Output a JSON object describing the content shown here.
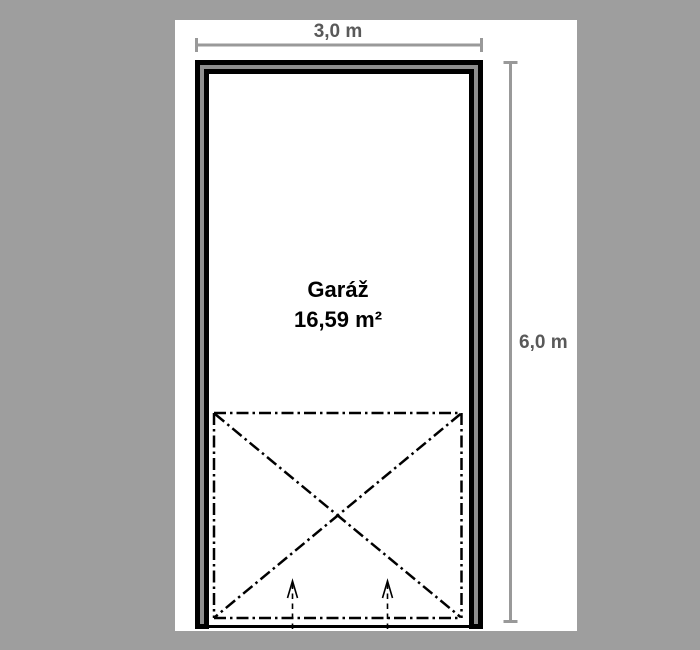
{
  "plan": {
    "room_name": "Garáž",
    "room_area": "16,59 m²",
    "width_label": "3,0 m",
    "height_label": "6,0 m"
  },
  "colors": {
    "background": "#9e9e9e",
    "paper": "#ffffff",
    "wall": "#000000",
    "wall_core": "#8f8f8f",
    "dimension_line": "#999999",
    "dimension_text": "#595959",
    "room_text": "#000000",
    "door_swing_line": "#000000"
  }
}
